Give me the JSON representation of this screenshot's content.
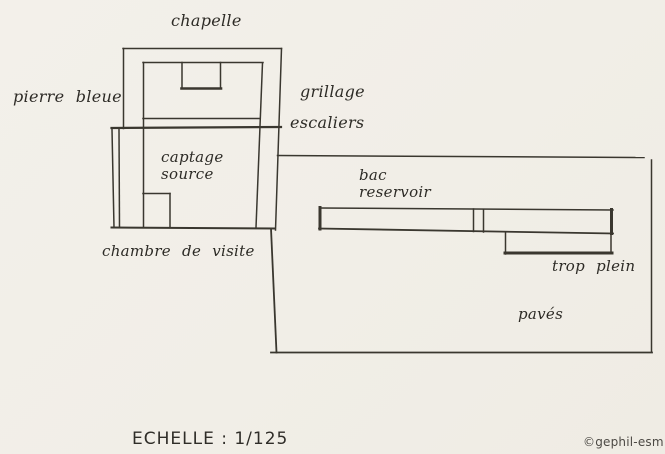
{
  "diagram": {
    "labels": {
      "chapelle": "chapelle",
      "pierre_bleue": "pierre bleue",
      "grillage": "grillage",
      "escaliers": "escaliers",
      "captage_line1": "captage",
      "captage_line2": "source",
      "chambre_de_visite": "chambre de visite",
      "bac_line1": "bac",
      "bac_line2": "reservoir",
      "trop_plein": "trop plein",
      "paves": "pavés"
    },
    "scale_label": "ECHELLE : 1/125",
    "credit": "©gephil-esm",
    "colors": {
      "paper": "#f2efe8",
      "ink": "#38352f"
    }
  }
}
